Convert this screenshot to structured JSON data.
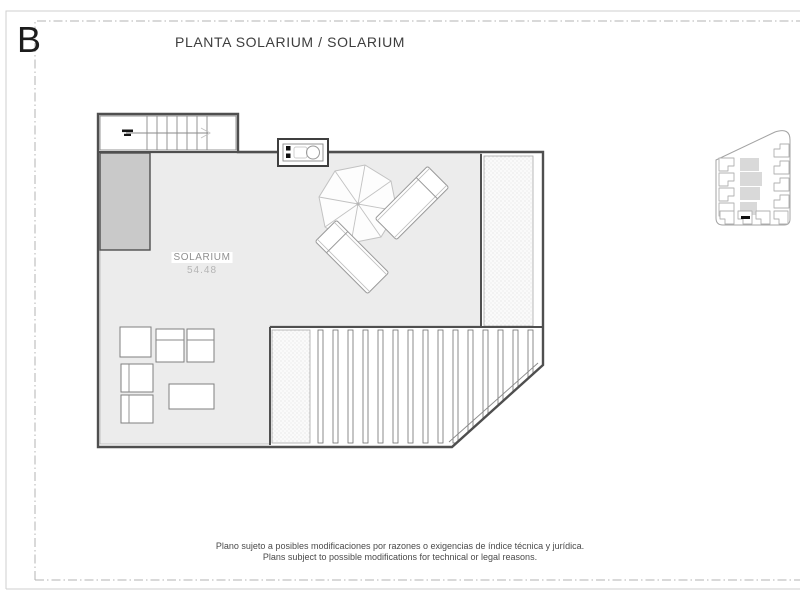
{
  "page": {
    "block_label": "B",
    "title": "PLANTA SOLARIUM / SOLARIUM"
  },
  "plan": {
    "room": {
      "label": "SOLARIUM",
      "area": "54.48"
    }
  },
  "footer": {
    "disclaimer_es": "Plano sujeto a posibles modificaciones por razones o exigencias de índice técnica y jurídica.",
    "disclaimer_en": "Plans subject to possible modifications for technical or legal reasons."
  },
  "icons": {
    "parasol": "octagonal-umbrella-top-view",
    "sun_lounger": "tilted-lounger-with-headrest",
    "barbecue": "outdoor-kitchen-unit-with-sink",
    "stair_arrow": "direction-of-climb-arrow",
    "keymap_marker": "black-unit-position-tick"
  },
  "colors": {
    "wall": "#4f4f4f",
    "floor": "#ececec",
    "shaft": "#c9c9c9",
    "keymap_highlight": "#d9d9d9",
    "text_dark": "#1f1f1f",
    "text_gray": "#8f8f8f"
  }
}
